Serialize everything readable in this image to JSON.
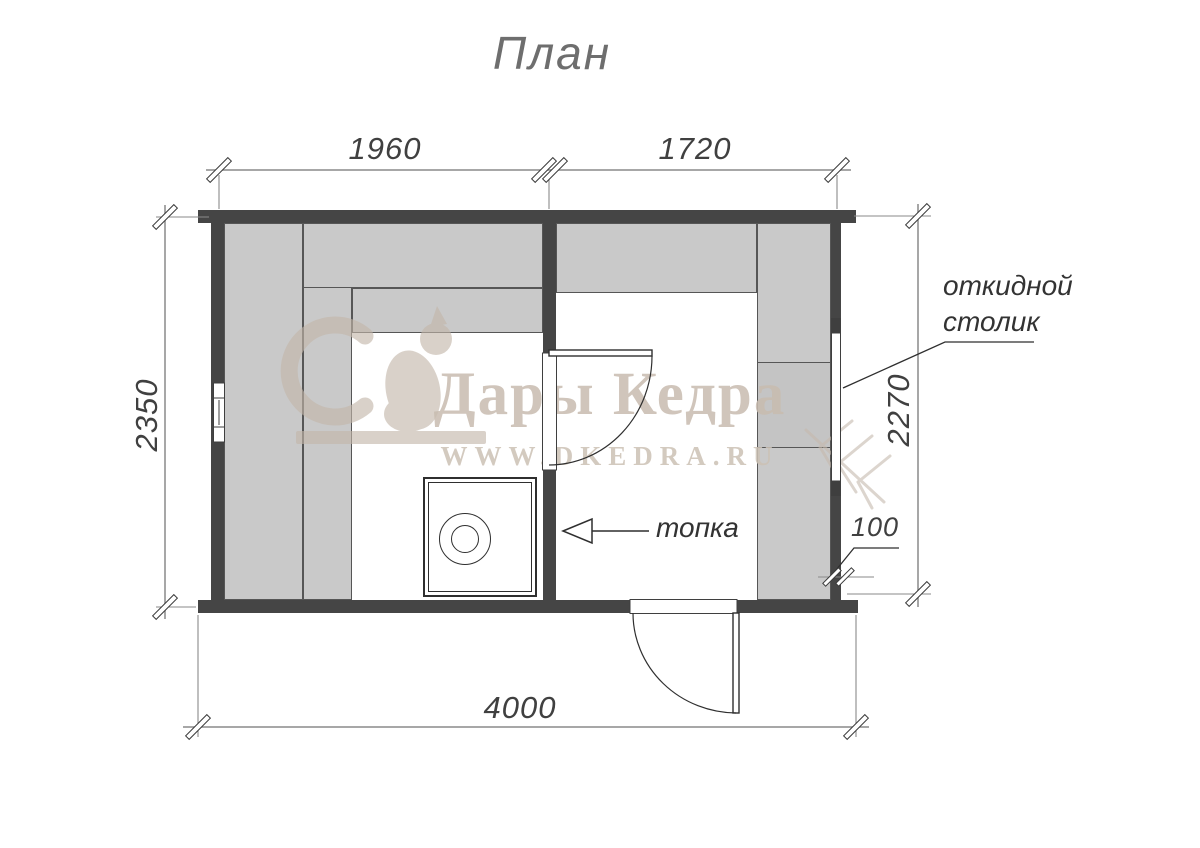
{
  "title": "План",
  "dims": {
    "top_left": "1960",
    "top_right": "1720",
    "left": "2350",
    "right": "2270",
    "bottom": "4000",
    "wall_thickness": "100"
  },
  "labels": {
    "folding_table_line1": "откидной",
    "folding_table_line2": "столик",
    "firebox": "топка"
  },
  "watermark": {
    "brand": "Дары Кедра",
    "site": "WWW.DKEDRA.RU"
  },
  "colors": {
    "wall": "#454545",
    "bench": "#c9c9c9",
    "drawing_line": "#2f2f2f",
    "dimension_line": "#8a8a8a",
    "watermark": "#c8bcb0"
  }
}
